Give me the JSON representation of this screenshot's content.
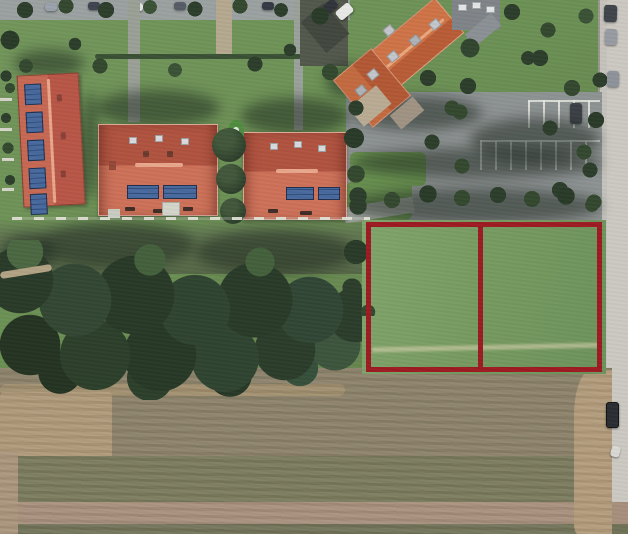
{
  "window": {
    "width": 628,
    "height": 534
  },
  "scene": {
    "type": "aerial-satellite-photo",
    "description": "Aerial satellite photo of a residential block: red-tiled houses with gardens at top, tree-lined parking bays and a road on the right, a dark tree grove mid-left, plowed farmland at the bottom, and two grassy building plots outlined in dark red.",
    "annotation": {
      "color": "#9e1b22",
      "stroke_px": 5,
      "parcels": [
        {
          "name": "left-plot"
        },
        {
          "name": "right-plot"
        }
      ]
    },
    "colors": {
      "annotation": "#9e1b22",
      "lawn": "#6b9054",
      "parcel_grass": "#789d66",
      "canopy": "#2c3e2b",
      "canopy_light": "#41573a",
      "olive_strip": "#5e7150",
      "field": "#8b8169",
      "field_tan": "#ae9878",
      "field_pink": "#a78f7c",
      "field_olive": "#79795c",
      "road": "#c6c3bd",
      "pavement": "#9ba1a1",
      "parking": "#8d9292",
      "roof_salmon": "#cd7159",
      "roof_dark": "#b05340",
      "roof_orange": "#c96f46",
      "roof_gray": "#7f8489",
      "solar_blue": "#3a5c92",
      "stripe_white": "#e4e6e0",
      "car_dark": "#3b4046"
    }
  }
}
